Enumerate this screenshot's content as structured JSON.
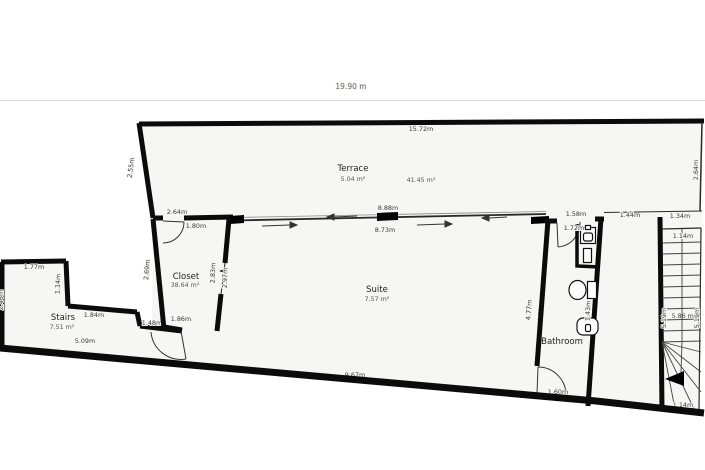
{
  "scale": {
    "total_width": "19.90 m"
  },
  "colors": {
    "wall": "#0b0b0b",
    "floor": "#f6f6f5",
    "background": "#ffffff"
  },
  "rooms": {
    "terrace": {
      "name": "Terrace",
      "area": "5.04 m²"
    },
    "open_area": {
      "area": "41.45 m²"
    },
    "closet": {
      "name": "Closet",
      "area": "38.64 m²"
    },
    "stairs": {
      "name": "Stairs",
      "area": "7.51 m²"
    },
    "suite": {
      "name": "Suite",
      "area": "7.57 m²"
    },
    "bathroom": {
      "name": "Bathroom"
    },
    "stairwell": {
      "area": "5.86 m²"
    }
  },
  "dims": {
    "terrace_top": "15.72m",
    "terrace_left": "2.55m",
    "terrace_right": "2.64m",
    "closet_top": "2.64m",
    "closet_door": "1.80m",
    "closet_left": "2.69m",
    "closet_right": "2.83m",
    "closet_opening": "2.97m",
    "closet_bottom": "1.86m",
    "slider_top": "8.88m",
    "slider_bottom": "8.73m",
    "stairs_top": "1.77m",
    "stairs_right_step": "1.14m",
    "stairs_mid": "1.84m",
    "stairs_bottom": "5.09m",
    "stairs_left": "2.46m",
    "hall_bottom": "1.48m",
    "suite_bottom": "9.67m",
    "suite_right": "4.77m",
    "bathroom_left": "4.78m",
    "bathroom_top": "1.58m",
    "bathroom_door": "1.72m",
    "bathroom_fixture": "1.43m",
    "bathroom_door_bottom": "1.60m",
    "corridor_top": "1.44m",
    "stairwell_top": "1.34m",
    "stairwell_width_top": "1.14m",
    "stairwell_left": "5.19m",
    "stairwell_right": "5.19m",
    "stairwell_width_bottom": "1.14m"
  }
}
